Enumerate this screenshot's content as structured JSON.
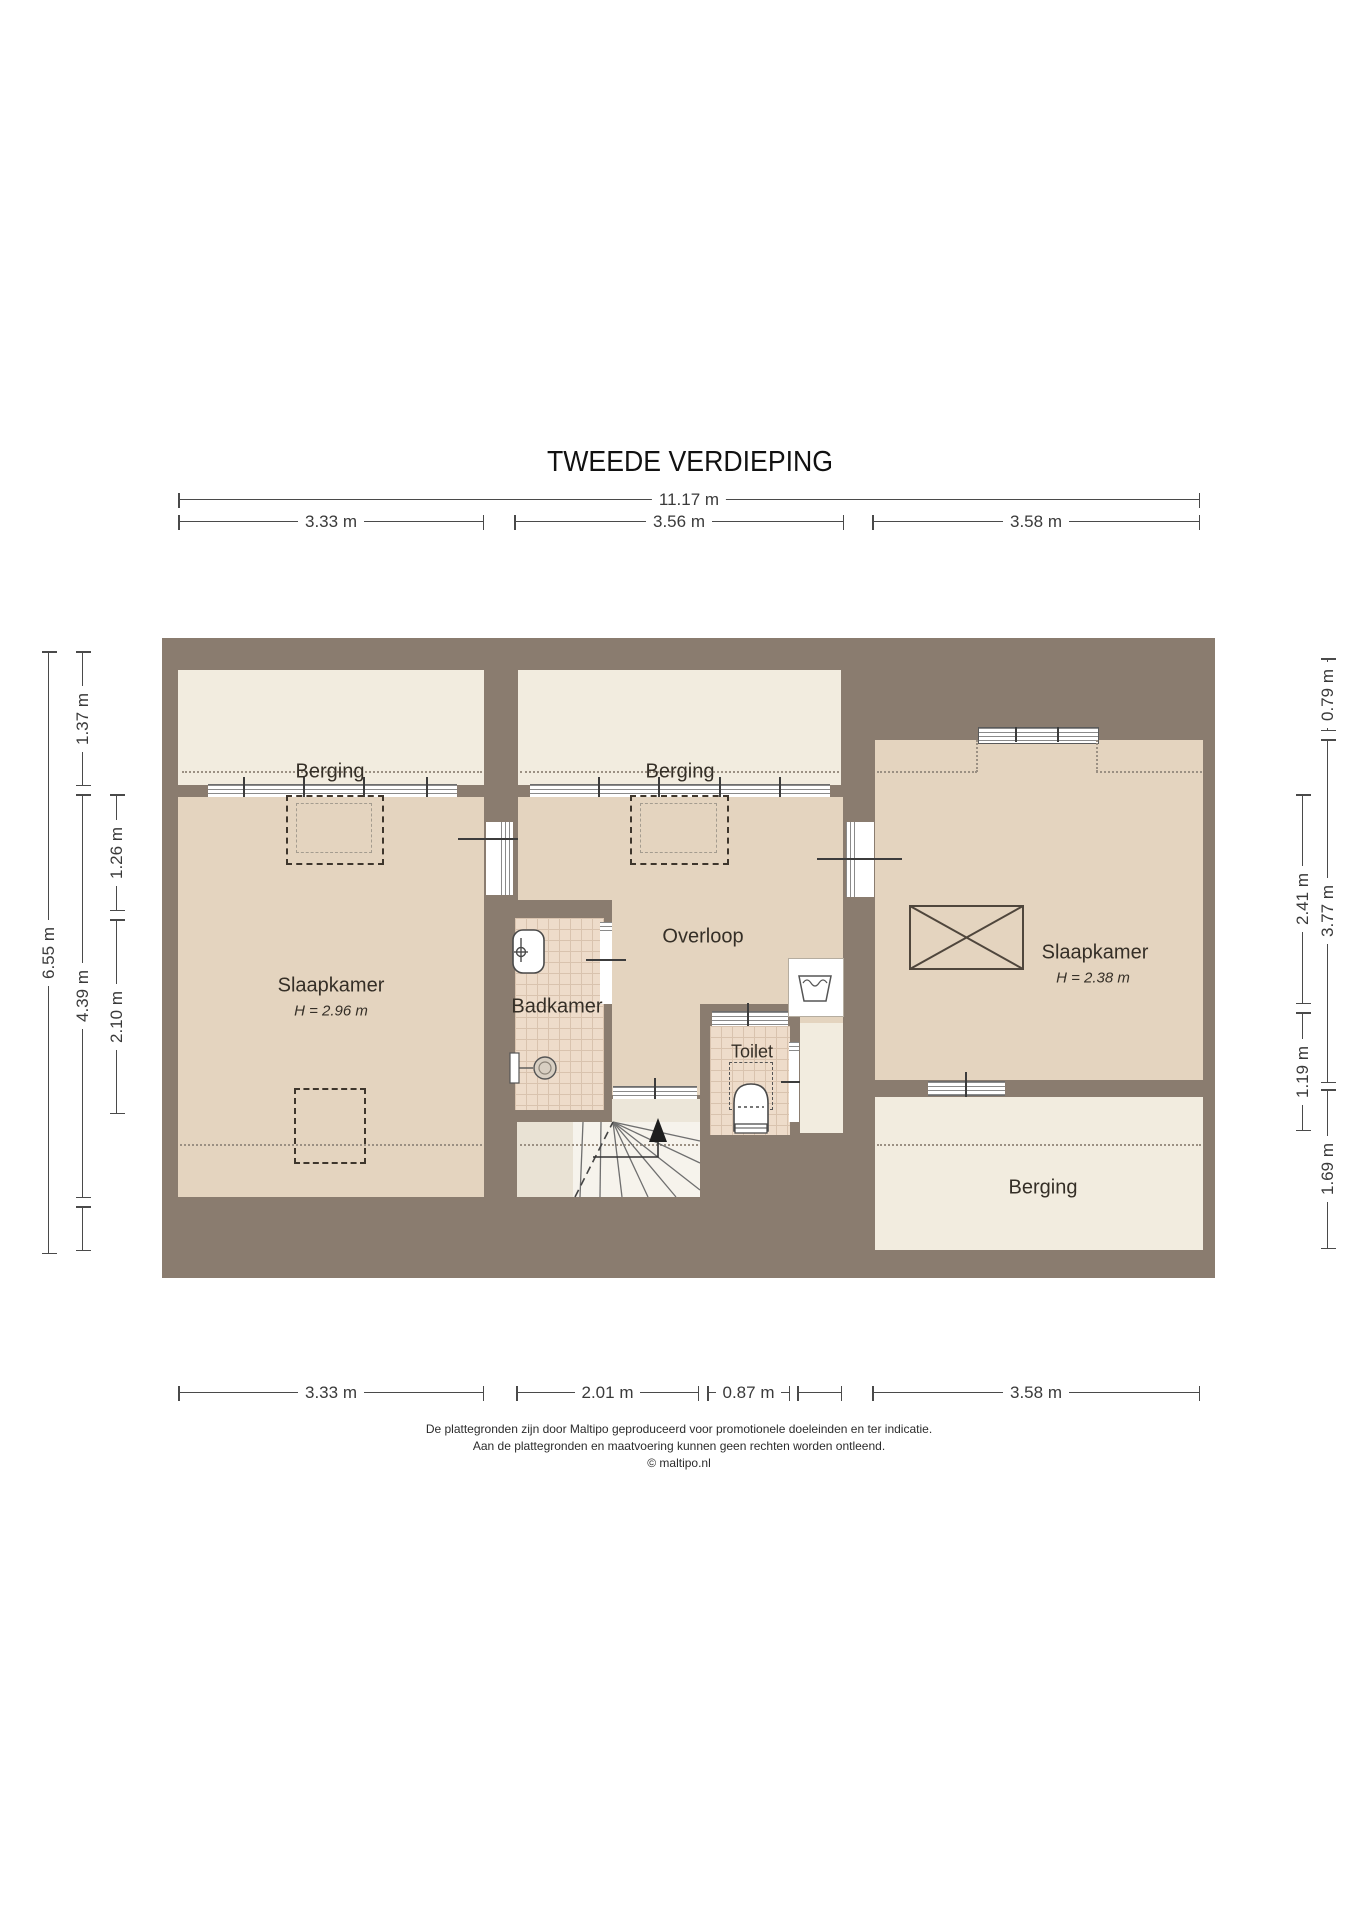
{
  "title": "TWEEDE VERDIEPING",
  "rooms": {
    "berging_left": "Berging",
    "berging_mid": "Berging",
    "berging_bottom": "Berging",
    "overloop": "Overloop",
    "badkamer": "Badkamer",
    "toilet": "Toilet",
    "slaapkamer_left": {
      "name": "Slaapkamer",
      "height": "H = 2.96 m"
    },
    "slaapkamer_right": {
      "name": "Slaapkamer",
      "height": "H = 2.38 m"
    }
  },
  "dims": {
    "top": [
      {
        "label": "11.17 m"
      },
      {
        "label": "3.33 m"
      },
      {
        "label": "3.56 m"
      },
      {
        "label": "3.58 m"
      }
    ],
    "bottom": [
      {
        "label": "3.33 m"
      },
      {
        "label": "2.01 m"
      },
      {
        "label": "0.87 m"
      },
      {
        "label": ""
      },
      {
        "label": "3.58 m"
      }
    ],
    "left": [
      {
        "label": "6.55 m"
      },
      {
        "label": "1.37 m"
      },
      {
        "label": "4.39 m"
      },
      {
        "label": ""
      },
      {
        "label": "1.26 m"
      },
      {
        "label": "2.10 m"
      }
    ],
    "right": [
      {
        "label": "0.79 m"
      },
      {
        "label": "3.77 m"
      },
      {
        "label": "1.69 m"
      },
      {
        "label": "2.41 m"
      },
      {
        "label": "1.19 m"
      }
    ]
  },
  "footer": {
    "line1": "De plattegronden zijn door Maltipo geproduceerd voor promotionele doeleinden en ter indicatie.",
    "line2": "Aan de plattegronden en maatvoering kunnen geen rechten worden ontleend.",
    "line3": "© maltipo.nl"
  },
  "colors": {
    "wall": "#8a7c6f",
    "floor": "#e4d4bf",
    "storage": "#f2ecdf",
    "tile": "#eedcca",
    "dimension": "#4a4a4a"
  }
}
